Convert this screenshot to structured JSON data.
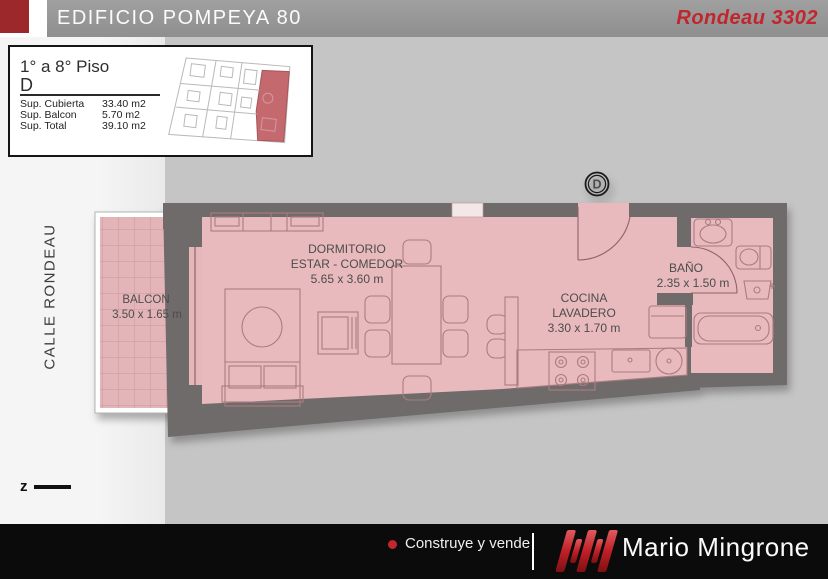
{
  "header": {
    "building": "EDIFICIO POMPEYA 80",
    "unit": "Rondeau 3302"
  },
  "info_box": {
    "floors": "1° a 8° Piso",
    "unit_letter": "D",
    "rows": [
      {
        "label": "Sup. Cubierta",
        "value": "33.40 m2"
      },
      {
        "label": "Sup. Balcon",
        "value": "5.70 m2"
      },
      {
        "label": "Sup. Total",
        "value": "39.10 m2"
      }
    ]
  },
  "plan": {
    "street": "CALLE RONDEAU",
    "unit_marker": "D",
    "north_letter": "z",
    "rooms": {
      "balcon": {
        "name": "BALCON",
        "dims": "3.50 x 1.65 m"
      },
      "dormitorio": {
        "line1": "DORMITORIO",
        "line2": "ESTAR - COMEDOR",
        "dims": "5.65 x 3.60 m"
      },
      "cocina": {
        "line1": "COCINA",
        "line2": "LAVADERO",
        "dims": "3.30 x 1.70 m"
      },
      "bano": {
        "name": "BAÑO",
        "dims": "2.35 x 1.50 m"
      }
    }
  },
  "footer": {
    "tagline": "Construye y vende",
    "brand": "Mario Mingrone"
  },
  "colors": {
    "accent_red": "#c0262c",
    "wall_gray": "#6f6b6b",
    "floor_pink": "#e8babd",
    "balcony_pink": "#e4b5b8",
    "footer_black": "#0b0b0b"
  }
}
